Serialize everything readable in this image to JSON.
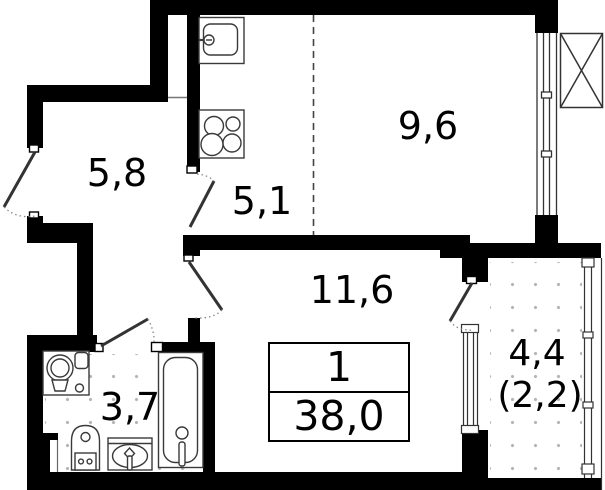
{
  "title": "Apartment floor plan",
  "apartment": {
    "number": "1",
    "total_area": "38,0"
  },
  "rooms": {
    "hallway": {
      "area": "5,8"
    },
    "kitchen": {
      "area": "5,1"
    },
    "bedroom": {
      "area": "9,6"
    },
    "living": {
      "area": "11,6"
    },
    "bathroom": {
      "area": "3,7"
    },
    "balcony": {
      "area": "4,4",
      "reduced_area": "(2,2)"
    }
  },
  "fixtures": [
    "kitchen-sink",
    "stove-4-burners",
    "washing-machine",
    "toilet",
    "washbasin",
    "bathtub",
    "ac-shaft-cross-box"
  ],
  "colors": {
    "wall": "#000000",
    "background": "#ffffff",
    "thin_line": "#3a3a3a",
    "floor_dot": "#b5b5b5"
  }
}
